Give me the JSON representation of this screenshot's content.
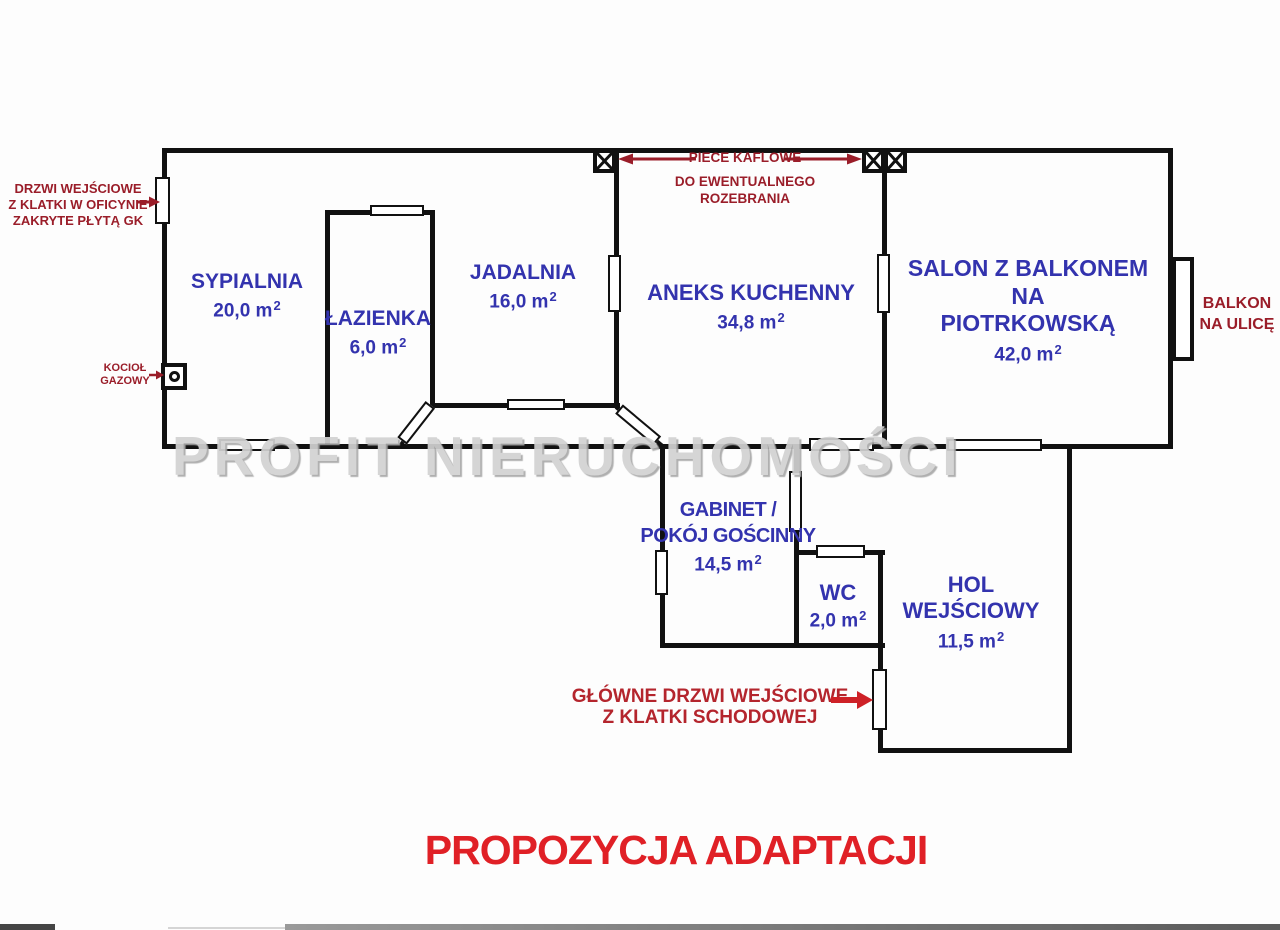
{
  "meta": {
    "area_sup": "2"
  },
  "colors": {
    "room_label": "#3333ae",
    "annotation_dark_red": "#9a1d29",
    "entrance_red": "#b4252d",
    "arrow_red": "#ce2127",
    "title_red": "#e02026",
    "wall_black": "#111111",
    "watermark_gray": "#d2d2d2"
  },
  "watermark": "PROFIT NIERUCHOMOŚCI",
  "title": "PROPOZYCJA ADAPTACJI",
  "rooms": {
    "sypialnia": {
      "name": "SYPIALNIA",
      "area": "20,0 m"
    },
    "lazienka": {
      "name": "ŁAZIENKA",
      "area": "6,0 m"
    },
    "jadalnia": {
      "name": "JADALNIA",
      "area": "16,0 m"
    },
    "aneks": {
      "name": "ANEKS KUCHENNY",
      "area": "34,8 m"
    },
    "salon": {
      "name1": "SALON Z BALKONEM NA",
      "name2": "PIOTRKOWSKĄ",
      "area": "42,0 m"
    },
    "gabinet": {
      "name1": "GABINET /",
      "name2": "POKÓJ GOŚCINNY",
      "area": "14,5 m"
    },
    "wc": {
      "name": "WC",
      "area": "2,0 m"
    },
    "hol": {
      "name1": "HOL",
      "name2": "WEJŚCIOWY",
      "area": "11,5 m"
    }
  },
  "annotations": {
    "side_door": {
      "line1": "DRZWI WEJŚCIOWE",
      "line2": "Z KLATKI W OFICYNIE",
      "line3": "ZAKRYTE PŁYTĄ GK"
    },
    "stoves": {
      "line1": "PIECE KAFLOWE",
      "line2": "DO EWENTUALNEGO",
      "line3": "ROZEBRANIA"
    },
    "boiler": {
      "line1": "KOCIOŁ",
      "line2": "GAZOWY"
    },
    "balcony": {
      "line1": "BALKON",
      "line2": "NA ULICĘ"
    },
    "main_door": {
      "line1": "GŁÓWNE DRZWI WEJŚCIOWE",
      "line2": "Z KLATKI SCHODOWEJ"
    }
  }
}
